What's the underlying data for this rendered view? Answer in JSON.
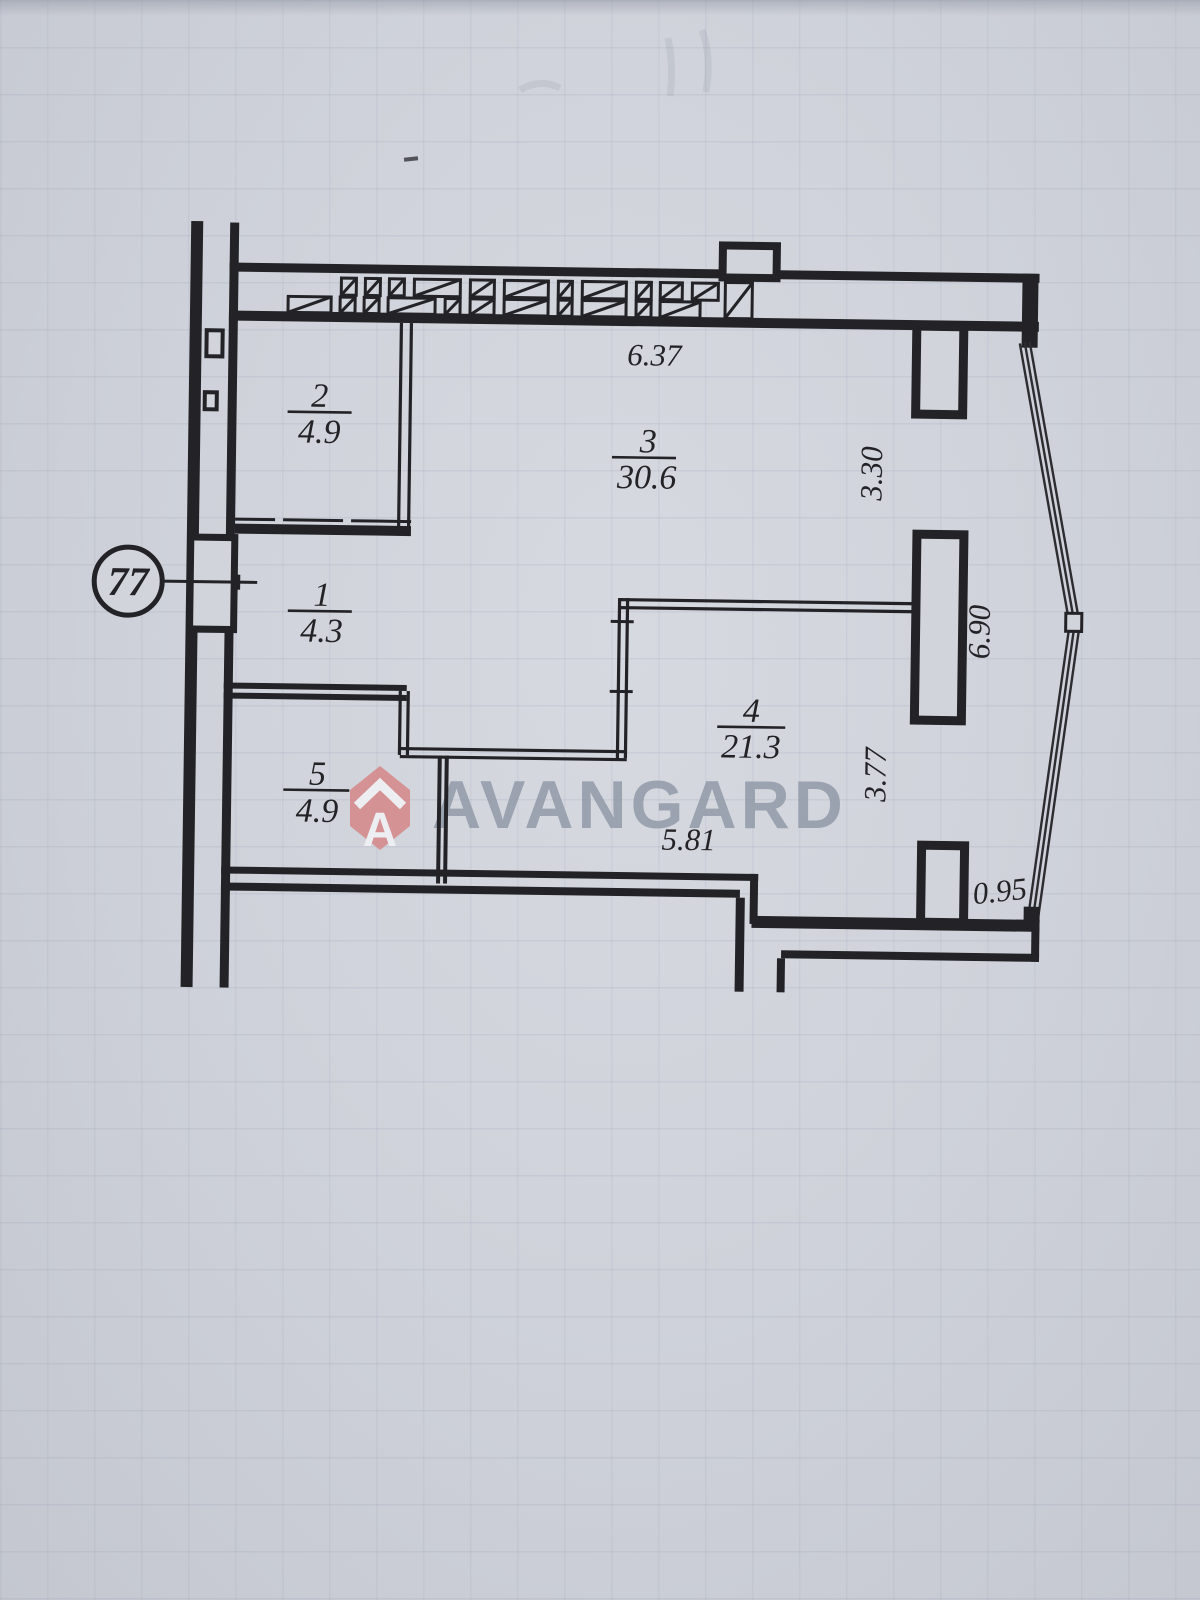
{
  "plan": {
    "apartment_number": "77",
    "rooms": [
      {
        "number": "1",
        "area": "4.3"
      },
      {
        "number": "2",
        "area": "4.9"
      },
      {
        "number": "3",
        "area": "30.6"
      },
      {
        "number": "4",
        "area": "21.3"
      },
      {
        "number": "5",
        "area": "4.9"
      }
    ],
    "dimensions": {
      "top_width": "6.37",
      "right_upper_height": "3.30",
      "right_window_height": "6.90",
      "right_lower_height": "3.77",
      "bottom_right_width": "0.95",
      "bottom_width": "5.81"
    }
  },
  "watermark": {
    "brand_text": "AVANGARD",
    "icon": "house-a-badge-icon",
    "badge_color": "#d68b8d",
    "text_color": "#939ca9"
  },
  "colors": {
    "ink": "#232327",
    "paper": "#d2d4db"
  }
}
